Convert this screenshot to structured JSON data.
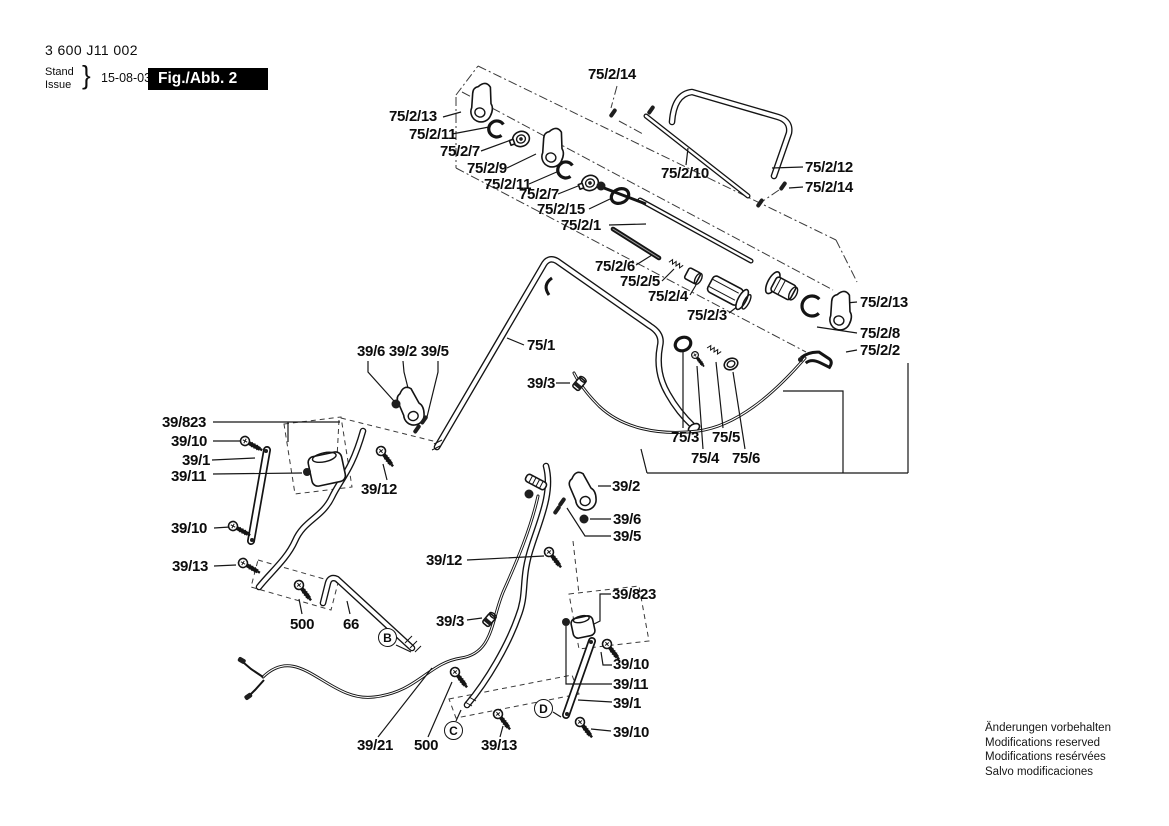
{
  "doc": {
    "part_number": "3 600 J11 002",
    "stand_label": "Stand",
    "issue_label": "Issue",
    "brace": "}",
    "date": "15-08-03",
    "figure": "Fig./Abb. 2",
    "footer_lines": [
      "Änderungen vorbehalten",
      "Modifications reserved",
      "Modifications resérvées",
      "Salvo modificaciones"
    ]
  },
  "colors": {
    "ink": "#141414",
    "paper": "#ffffff",
    "fig_box_bg": "#000000",
    "fig_box_fg": "#ffffff"
  },
  "labels": [
    {
      "text": "75/2/14",
      "x": 588,
      "y": 67
    },
    {
      "text": "75/2/13",
      "x": 389,
      "y": 109
    },
    {
      "text": "75/2/11",
      "x": 409,
      "y": 127
    },
    {
      "text": "75/2/7",
      "x": 440,
      "y": 144
    },
    {
      "text": "75/2/9",
      "x": 467,
      "y": 161
    },
    {
      "text": "75/2/11",
      "x": 484,
      "y": 177
    },
    {
      "text": "75/2/7",
      "x": 519,
      "y": 187
    },
    {
      "text": "75/2/15",
      "x": 537,
      "y": 202
    },
    {
      "text": "75/2/1",
      "x": 561,
      "y": 218
    },
    {
      "text": "75/2/10",
      "x": 661,
      "y": 166
    },
    {
      "text": "75/2/12",
      "x": 805,
      "y": 160
    },
    {
      "text": "75/2/14",
      "x": 805,
      "y": 180
    },
    {
      "text": "75/2/6",
      "x": 595,
      "y": 259
    },
    {
      "text": "75/2/5",
      "x": 620,
      "y": 274
    },
    {
      "text": "75/2/4",
      "x": 648,
      "y": 289
    },
    {
      "text": "75/2/3",
      "x": 687,
      "y": 308
    },
    {
      "text": "75/2/13",
      "x": 860,
      "y": 295
    },
    {
      "text": "75/2/8",
      "x": 860,
      "y": 326
    },
    {
      "text": "75/2/2",
      "x": 860,
      "y": 343
    },
    {
      "text": "75/1",
      "x": 527,
      "y": 338
    },
    {
      "text": "39/6 39/2 39/5",
      "x": 357,
      "y": 344
    },
    {
      "text": "39/3",
      "x": 527,
      "y": 376
    },
    {
      "text": "75/3",
      "x": 671,
      "y": 430
    },
    {
      "text": "75/5",
      "x": 712,
      "y": 430
    },
    {
      "text": "75/4",
      "x": 691,
      "y": 451
    },
    {
      "text": "75/6",
      "x": 732,
      "y": 451
    },
    {
      "text": "39/823",
      "x": 162,
      "y": 415
    },
    {
      "text": "39/10",
      "x": 171,
      "y": 434
    },
    {
      "text": "39/1",
      "x": 182,
      "y": 453
    },
    {
      "text": "39/11",
      "x": 171,
      "y": 469
    },
    {
      "text": "39/12",
      "x": 361,
      "y": 482
    },
    {
      "text": "39/10",
      "x": 171,
      "y": 521
    },
    {
      "text": "39/13",
      "x": 172,
      "y": 559
    },
    {
      "text": "500",
      "x": 290,
      "y": 617
    },
    {
      "text": "66",
      "x": 343,
      "y": 617
    },
    {
      "text": "39/3",
      "x": 436,
      "y": 614
    },
    {
      "text": "39/12",
      "x": 426,
      "y": 553
    },
    {
      "text": "39/2",
      "x": 612,
      "y": 479
    },
    {
      "text": "39/6",
      "x": 613,
      "y": 512
    },
    {
      "text": "39/5",
      "x": 613,
      "y": 529
    },
    {
      "text": "39/823",
      "x": 612,
      "y": 587
    },
    {
      "text": "39/10",
      "x": 613,
      "y": 657
    },
    {
      "text": "39/11",
      "x": 613,
      "y": 677
    },
    {
      "text": "39/1",
      "x": 613,
      "y": 696
    },
    {
      "text": "39/10",
      "x": 613,
      "y": 725
    },
    {
      "text": "39/21",
      "x": 357,
      "y": 738
    },
    {
      "text": "500",
      "x": 414,
      "y": 738
    },
    {
      "text": "39/13",
      "x": 481,
      "y": 738
    }
  ],
  "callouts": [
    {
      "letter": "B",
      "cx": 388,
      "cy": 638
    },
    {
      "letter": "C",
      "cx": 454,
      "cy": 731
    },
    {
      "letter": "D",
      "cx": 544,
      "cy": 709
    }
  ]
}
